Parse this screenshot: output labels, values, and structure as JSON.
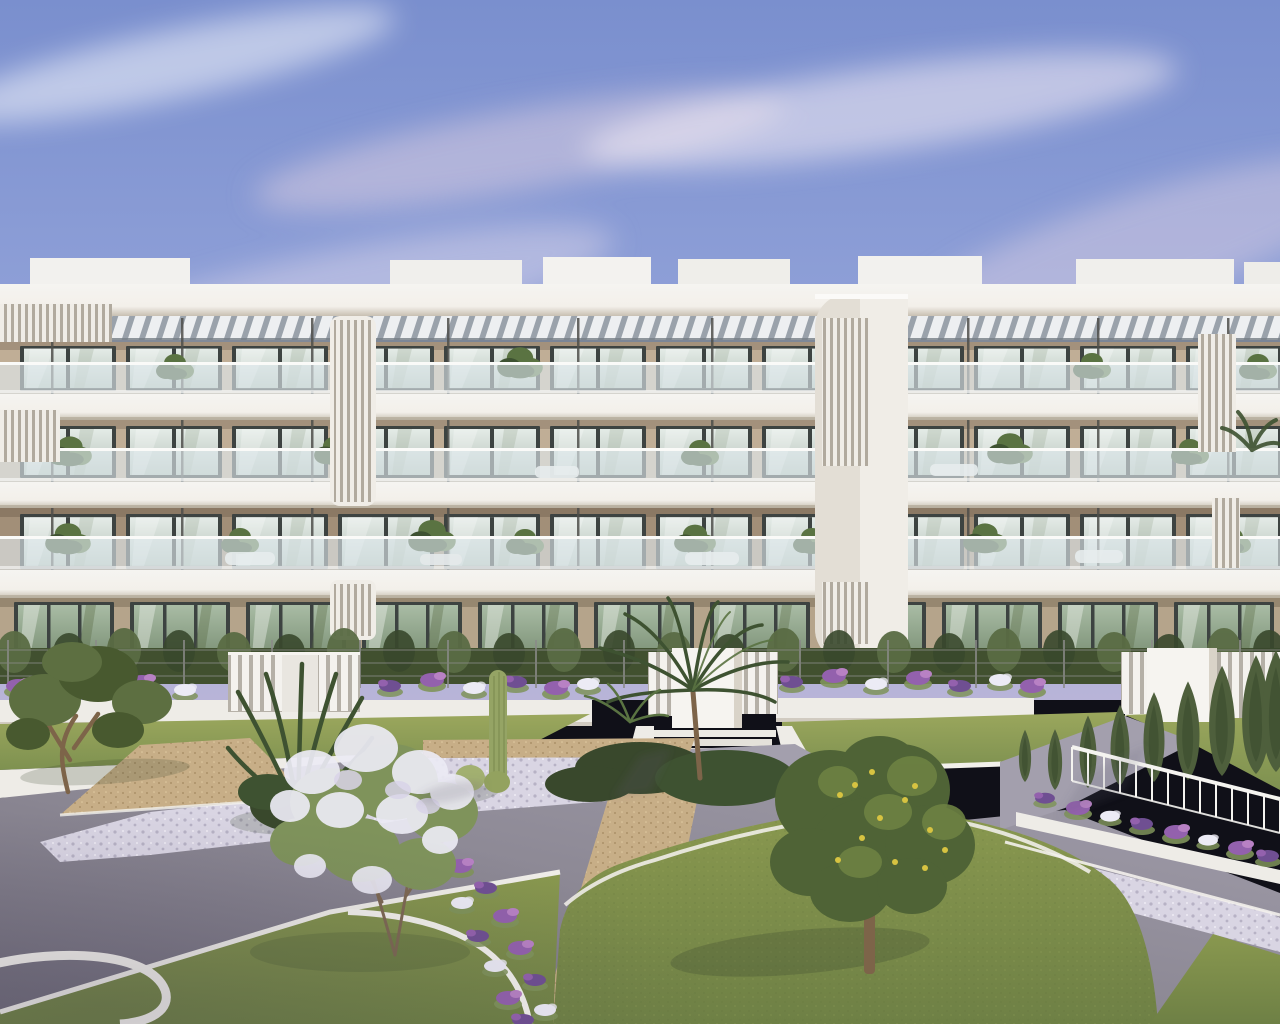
{
  "scene": {
    "type": "exterior-architectural-render",
    "building": {
      "floors": 4,
      "balcony_rows": 3,
      "windows_per_upper_floor": 12,
      "ground_floor_doors": 11,
      "roof": "louvered-pergola",
      "vertical_louver_screens": 4
    },
    "garden": {
      "gates": 3,
      "features": [
        "cypress-hedge",
        "wire-fence",
        "flower-planters",
        "terraced-lawns",
        "gravel-paths",
        "asphalt-paths",
        "white-pebble-beds",
        "white-curbs",
        "olive-tree",
        "fan-palm-cluster",
        "fern-bush",
        "cactus",
        "lilac-bush",
        "lemon-tree",
        "white-railing",
        "tall-cypresses"
      ]
    }
  },
  "colors": {
    "sky-top": "#7a8fce",
    "sky-mid": "#94a4da",
    "sky-horizon": "#b8b4d8",
    "cloud": "#ddd0e2",
    "parapet": "#f5f4f1",
    "slab": "#f3f0ea",
    "slab-shadow": "#c8c0b2",
    "pergola-slat": "#edeff1",
    "pergola-gap": "#9aa2ab",
    "pergola-shadow": "#767e86",
    "wall": "#c0ae96",
    "wall-shade": "#a28f78",
    "wall-ground": "#b5a48b",
    "frame": "#3d4341",
    "glass-hi": "#e4ebe7",
    "glass-lo": "#b4c2b8",
    "glass-ground-hi": "#a9bca5",
    "glass-ground-lo": "#7c9176",
    "balustrade": "#e2ebf0",
    "handrail": "#fafaf8",
    "tower": "#f0ede7",
    "louver-gap": "#b1aa9e",
    "post": "#4d4e4a",
    "hedge": "#41502f",
    "hedge-light": "#5a6c44",
    "cypress": "#4e5f3c",
    "cypress-dark": "#39482c",
    "lawn": "#89984f",
    "lawn-light": "#9ba75d",
    "lawn-shade": "#6e8045",
    "lawn-terrace": "#7e9150",
    "gravel": "#c7ae87",
    "gravel-dot": "#ab9069",
    "pebble": "#d9d5e3",
    "pebble-dot": "#b7b2c5",
    "asphalt-light": "#a39fad",
    "asphalt": "#8b8793",
    "asphalt-dark": "#6e6a78",
    "flower-purple": "#9361ad",
    "flower-violet": "#6f4f92",
    "flower-pink": "#b881c4",
    "flower-white": "#ecebf5",
    "olive": "#5d6f41",
    "olive-dark": "#48592f",
    "bush-green": "#7f935b",
    "palm": "#3e5231",
    "palm-light": "#5a7342",
    "lemon": "#4f6336",
    "lemon-light": "#6d8243",
    "fruit": "#d7c341",
    "trunk": "#7d6449",
    "white-wall": "#eeece7",
    "railing": "#f3f2ee",
    "shadow": "#32412a"
  }
}
